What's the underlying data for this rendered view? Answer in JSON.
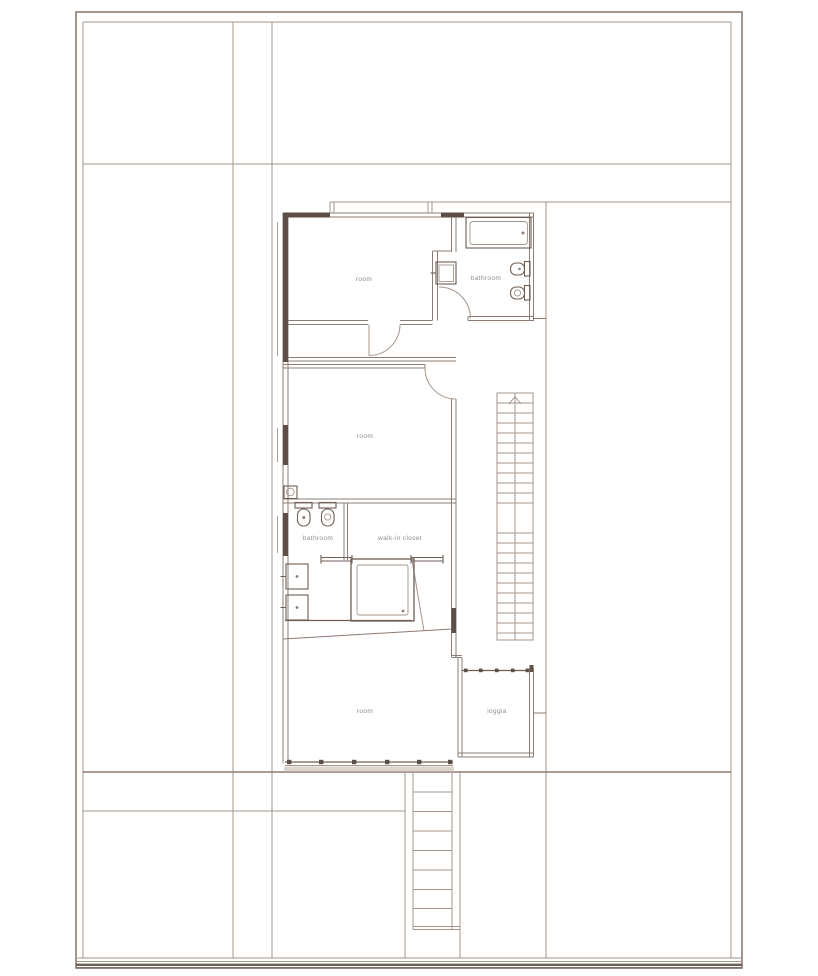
{
  "plan": {
    "kind": "floor-plan-drawing",
    "labels": {
      "room_top": "room",
      "bathroom_top": "bathroom",
      "room_middle": "room",
      "bathroom_lower": "bathroom",
      "walk_in_closet": "walk-in closet",
      "room_bottom": "room",
      "loggia": "loggia"
    },
    "fixtures": [
      "bathtub",
      "washbasin",
      "toilet",
      "bidet",
      "shower",
      "double-washbasin",
      "closet-rails",
      "glazed-wall"
    ],
    "stairs": {
      "upper": {
        "direction": "up",
        "treads": 22
      },
      "lower": {
        "treads": 8
      }
    },
    "colors": {
      "paper": "#ffffff",
      "line_light": "#a4948a",
      "line_medium": "#8d7c72",
      "wall_fill_dark": "#5d4f45",
      "fixture_line": "#6e5e54",
      "label_text": "#8c8c8c",
      "terrace_strip": "#dcd5ce"
    }
  }
}
